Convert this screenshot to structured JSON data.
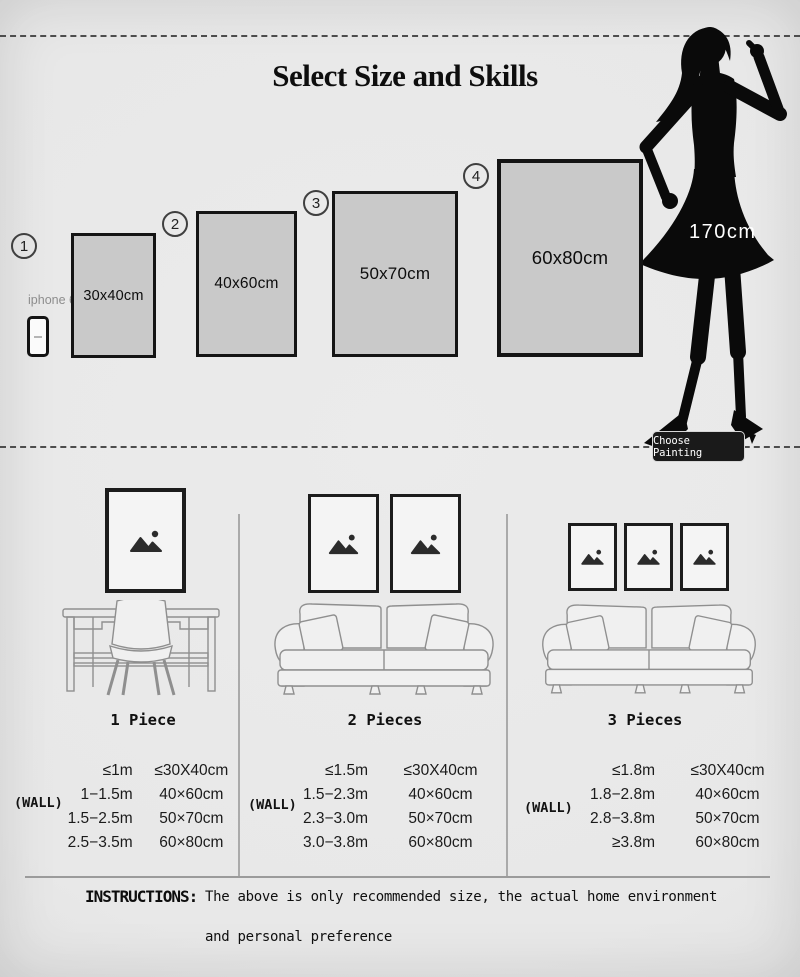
{
  "title": "Select Size and Skills",
  "size_chart": {
    "phone": {
      "label": "iphone 6"
    },
    "items": [
      {
        "number": "1",
        "size": "30x40cm"
      },
      {
        "number": "2",
        "size": "40x60cm"
      },
      {
        "number": "3",
        "size": "50x70cm"
      },
      {
        "number": "4",
        "size": "60x80cm"
      }
    ],
    "model_height": "170cm",
    "choose_button": "Choose Painting"
  },
  "sections": [
    {
      "label": "1 Piece",
      "wall": "(WALL)",
      "rows": [
        {
          "range": "≤1m",
          "size": "≤30X40cm"
        },
        {
          "range": "1−1.5m",
          "size": "40×60cm"
        },
        {
          "range": "1.5−2.5m",
          "size": "50×70cm"
        },
        {
          "range": "2.5−3.5m",
          "size": "60×80cm"
        }
      ]
    },
    {
      "label": "2 Pieces",
      "wall": "(WALL)",
      "rows": [
        {
          "range": "≤1.5m",
          "size": "≤30X40cm"
        },
        {
          "range": "1.5−2.3m",
          "size": "40×60cm"
        },
        {
          "range": "2.3−3.0m",
          "size": "50×70cm"
        },
        {
          "range": "3.0−3.8m",
          "size": "60×80cm"
        }
      ]
    },
    {
      "label": "3 Pieces",
      "wall": "(WALL)",
      "rows": [
        {
          "range": "≤1.8m",
          "size": "≤30X40cm"
        },
        {
          "range": "1.8−2.8m",
          "size": "40×60cm"
        },
        {
          "range": "2.8−3.8m",
          "size": "50×70cm"
        },
        {
          "range": "≥3.8m",
          "size": "60×80cm"
        }
      ]
    }
  ],
  "instructions": {
    "label": "INSTRUCTIONS:",
    "line1": "The above is only recommended size, the actual home environment",
    "line2": "and personal preference"
  },
  "colors": {
    "background": "#e9e9e9",
    "swatch_fill": "#c9c9c9",
    "silhouette": "#0a0a0a",
    "button_bg": "#1a1a1a",
    "button_text": "#ffffff"
  }
}
